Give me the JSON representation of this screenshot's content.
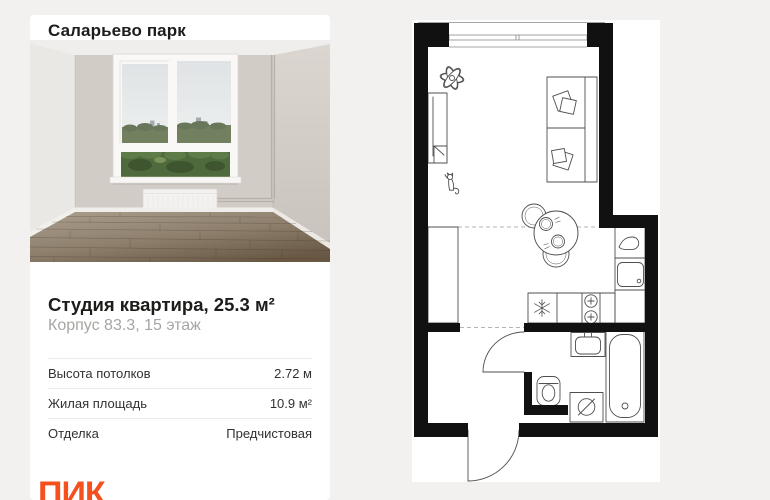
{
  "card": {
    "project_title": "Саларьево парк",
    "apartment_title": "Студия квартира, 25.3 м²",
    "apartment_subtitle": "Корпус 83.3, 15 этаж",
    "specs": [
      {
        "label": "Высота потолков",
        "value": "2.72 м"
      },
      {
        "label": "Жилая площадь",
        "value": "10.9 м²"
      },
      {
        "label": "Отделка",
        "value": "Предчистовая"
      }
    ],
    "brand_logo": "ПИК"
  },
  "colors": {
    "page_background": "#f2f1ef",
    "card_background": "#ffffff",
    "brand_orange": "#f4511e",
    "plan_walls": "#111111",
    "plan_background": "#ffffff",
    "subtitle_gray": "#a8a6a3"
  },
  "floorplan": {
    "fixtures": [
      "window",
      "plant",
      "wardrobe",
      "hall-closet",
      "cat",
      "sofa",
      "pillows",
      "dining-table",
      "chairs",
      "plates",
      "kitchen-counter",
      "fridge",
      "stove-burners",
      "kitchen-sink",
      "tap",
      "bathroom-door",
      "entrance-door",
      "bathroom-sink",
      "bathtub",
      "toilet",
      "washing-machine"
    ]
  }
}
